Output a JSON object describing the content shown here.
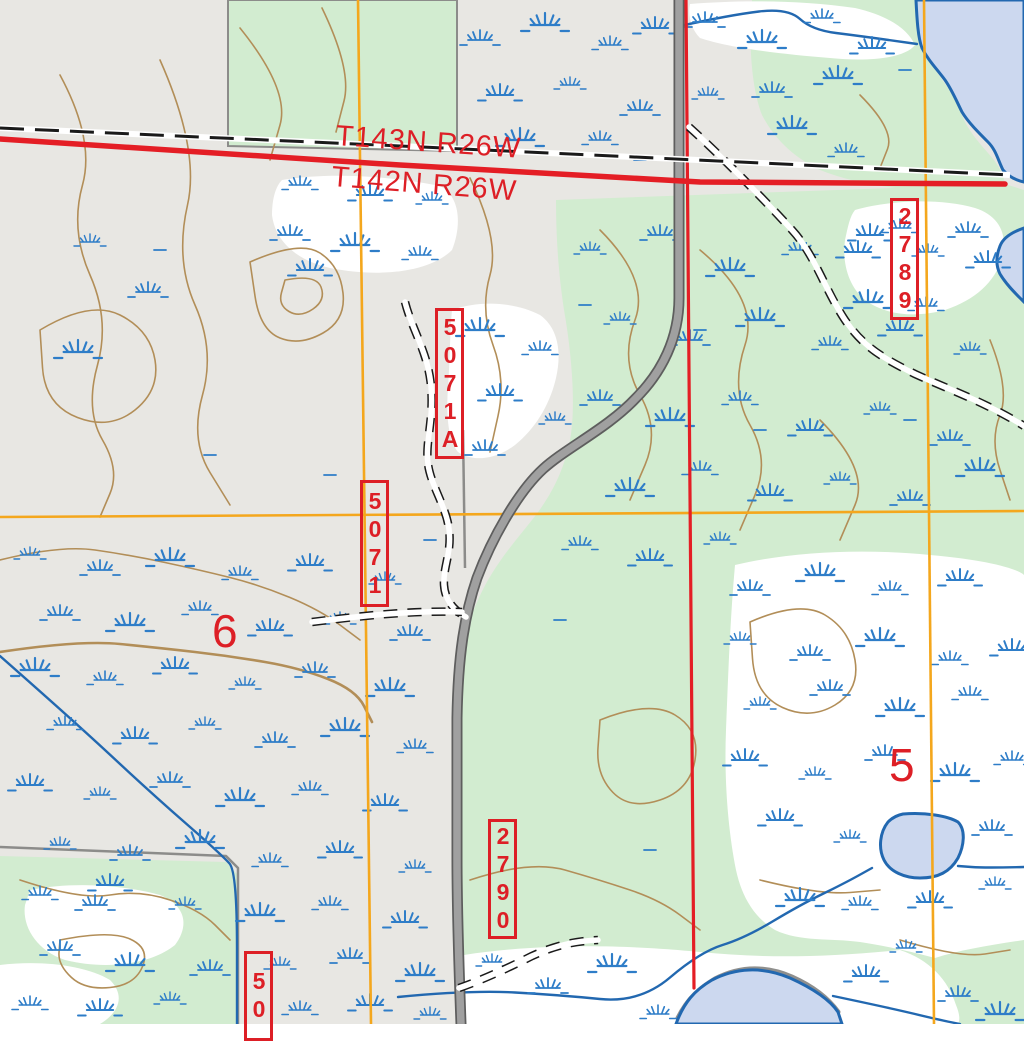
{
  "township_labels": [
    {
      "text": "T143N R26W"
    },
    {
      "text": "T142N R26W"
    }
  ],
  "section_numbers": [
    {
      "text": "6"
    },
    {
      "text": "5"
    }
  ],
  "road_labels": [
    {
      "text": "5071A"
    },
    {
      "text": "5071"
    },
    {
      "text": "2789"
    },
    {
      "text": "2790"
    },
    {
      "text": "50"
    }
  ],
  "colors": {
    "background_gray": "#e8e7e3",
    "forest_green": "#d2ecd0",
    "wetland_white": "#ffffff",
    "contour_brown": "#b28e58",
    "water_blue": "#2268b0",
    "lake_fill": "#ccd8ef",
    "marsh_blue": "#2e7dc8",
    "road_gray": "#a0a0a0",
    "section_line_orange": "#f4a71d",
    "boundary_red": "#e41e25",
    "label_red": "#dd1f26",
    "trail_black": "#1a1a1a",
    "gray_boundary": "#8c8c8a"
  }
}
